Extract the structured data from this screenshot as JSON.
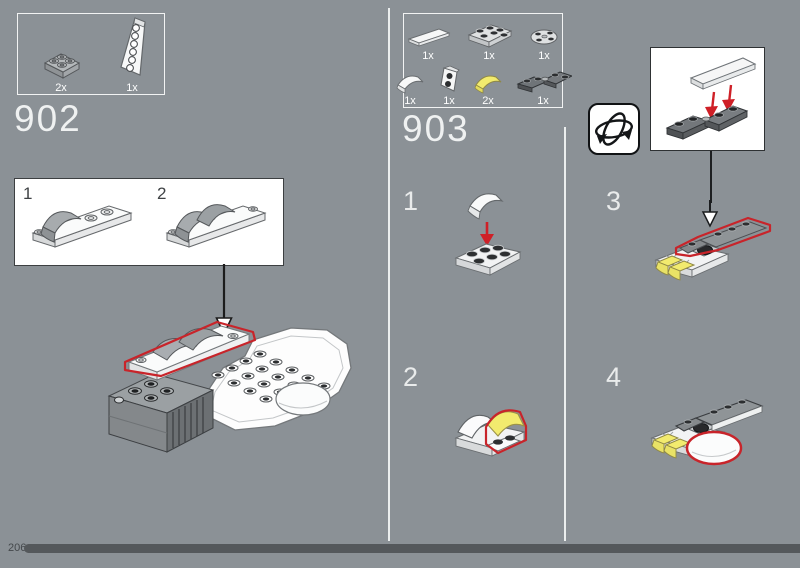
{
  "page": {
    "number": "206"
  },
  "colors": {
    "background": "#8b9196",
    "accent_red": "#c8242a",
    "piece_yellow": "#f2eb6e",
    "progress_bar": "#54585b"
  },
  "icons": {
    "rotate": "rotate-model-3d-icon",
    "place_arrow": "place-part-arrow-icon"
  },
  "step902": {
    "number": "902",
    "parts": [
      {
        "count": "2x",
        "part": "plate-2x2-light-gray"
      },
      {
        "count": "1x",
        "part": "wedge-plate-white"
      }
    ],
    "callout": {
      "steps": [
        {
          "label": "1"
        },
        {
          "label": "2"
        }
      ]
    }
  },
  "step903": {
    "number": "903",
    "parts": [
      {
        "count": "1x",
        "part": "tile-1x4-white"
      },
      {
        "count": "1x",
        "part": "plate-2x3-gray"
      },
      {
        "count": "1x",
        "part": "plate-round-2x2-gray"
      },
      {
        "count": "1x",
        "part": "slope-curved-1x2-white"
      },
      {
        "count": "1x",
        "part": "bracket-1x2-white"
      },
      {
        "count": "2x",
        "part": "slope-curved-1x2-yellow"
      },
      {
        "count": "1x",
        "part": "plates-1x2-angled-dark-gray"
      }
    ],
    "substeps": [
      {
        "label": "1"
      },
      {
        "label": "2"
      },
      {
        "label": "3"
      },
      {
        "label": "4"
      }
    ]
  }
}
